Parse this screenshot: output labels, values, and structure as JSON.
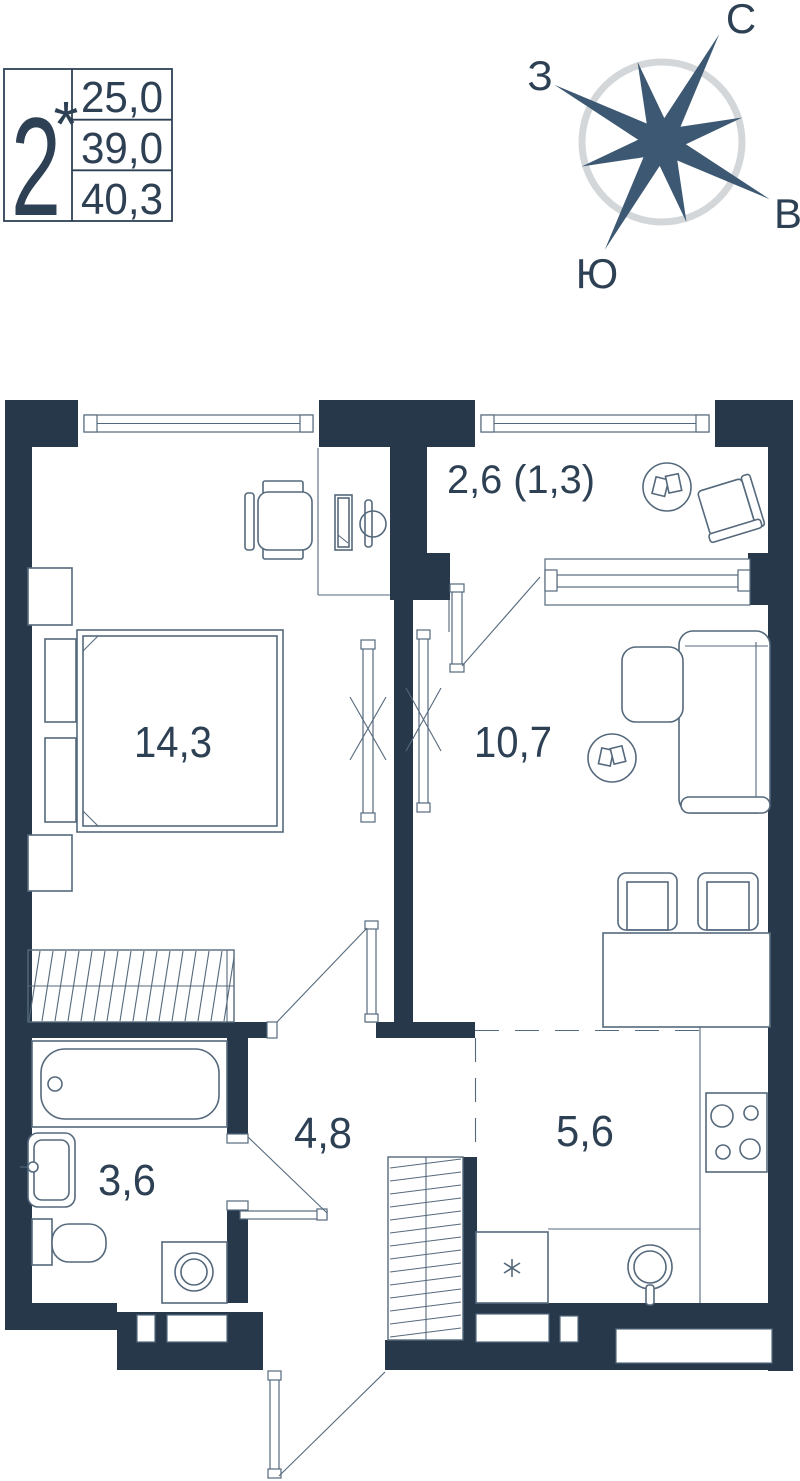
{
  "legend": {
    "rooms_count": "2",
    "rooms_note": "*",
    "living_area": "25,0",
    "total_area": "39,0",
    "total_area_with_balcony": "40,3"
  },
  "compass": {
    "north": "С",
    "east": "В",
    "south": "Ю",
    "west": "З"
  },
  "rooms": {
    "bedroom": {
      "area": "14,3"
    },
    "living": {
      "area": "10,7"
    },
    "balcony": {
      "area": "2,6 (1,3)"
    },
    "hallway": {
      "area": "4,8"
    },
    "kitchen": {
      "area": "5,6"
    },
    "bathroom": {
      "area": "3,6"
    }
  },
  "colors": {
    "wall": "#26384a",
    "line": "#55697c",
    "accent_text": "#2e4154",
    "compass_star": "#3d5872",
    "compass_ring": "#d3d7da"
  }
}
